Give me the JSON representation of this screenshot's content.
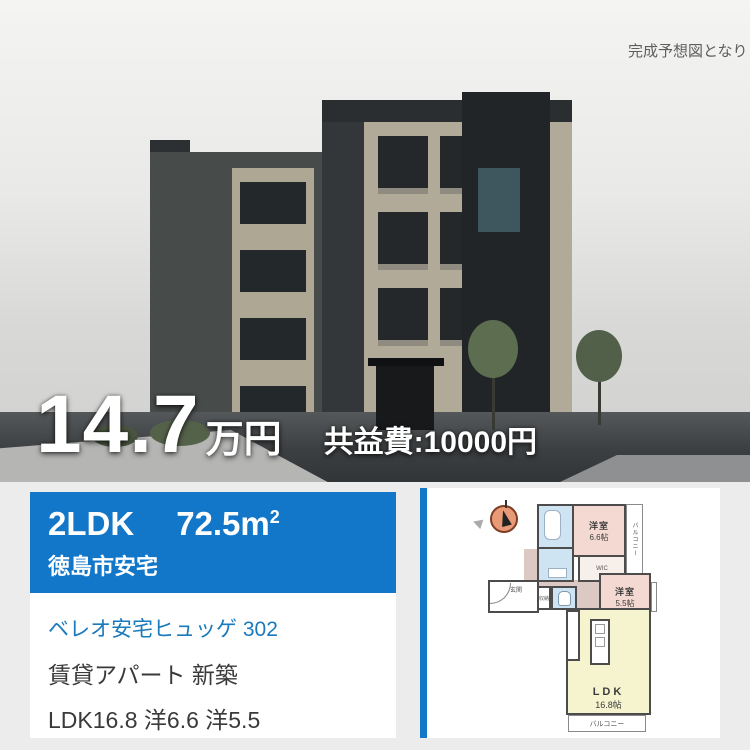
{
  "photo": {
    "caption": "完成予想図となります",
    "price": {
      "amount": "14.7",
      "unit": "万円",
      "fee": "共益費:10000円"
    }
  },
  "card": {
    "header": {
      "layout": "2LDK",
      "size_value": "72.5m",
      "size_sup": "2",
      "location": "徳島市安宅"
    },
    "title": "ベレオ安宅ヒュッゲ 302",
    "category": "賃貸アパート 新築",
    "rooms": "LDK16.8 洋6.6 洋5.5"
  },
  "floorplan": {
    "bedroom1_name": "洋室",
    "bedroom1_size": "6.6帖",
    "bedroom2_name": "洋室",
    "bedroom2_size": "5.5帖",
    "ldk_name": "LDK",
    "ldk_size": "16.8帖",
    "wic": "WIC",
    "entrance": "玄関",
    "storage": "収納",
    "balcony_side": "バルコニー",
    "balcony_bottom": "バルコニー"
  },
  "colors": {
    "accent_blue": "#1277c8",
    "link_blue": "#1a7abc",
    "room_pink": "#f3d9d1",
    "room_yellow": "#f6f4cf",
    "room_blue": "#cfe4f2"
  }
}
